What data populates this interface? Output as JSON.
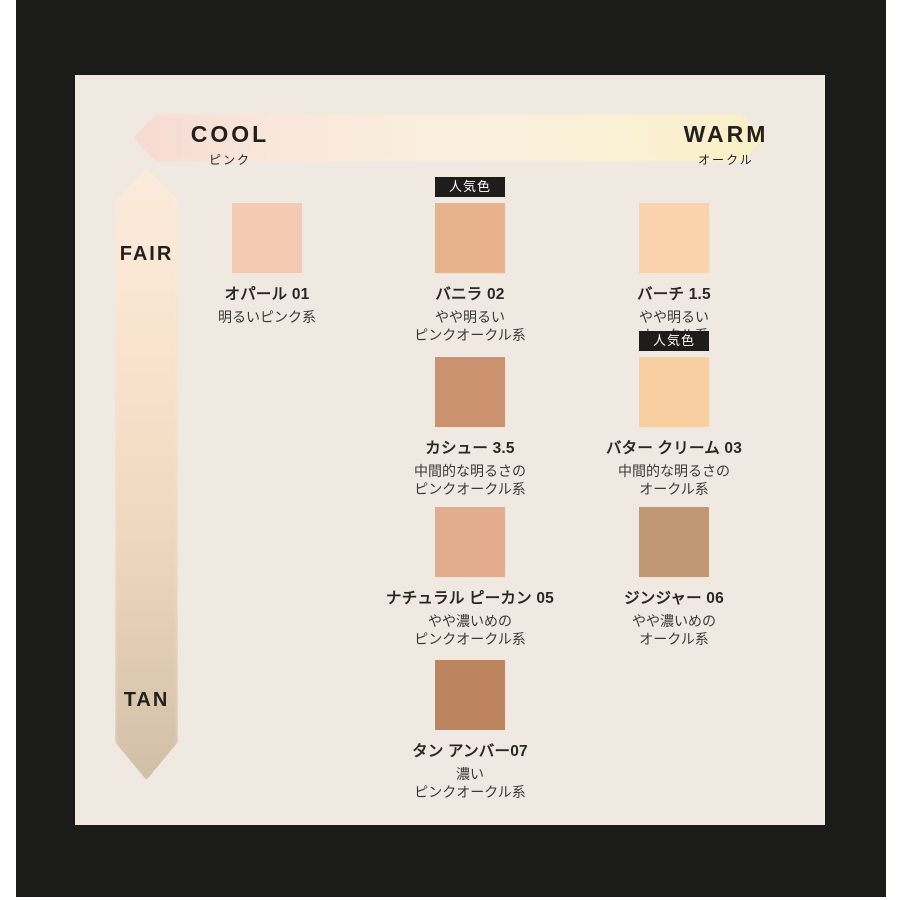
{
  "page": {
    "background": "#FFFFFF",
    "frame_color": "#1B1B19",
    "panel_color": "#F0E9E2"
  },
  "axes": {
    "horizontal": {
      "left_label": "COOL",
      "left_sublabel": "ピンク",
      "right_label": "WARM",
      "right_sublabel": "オークル",
      "gradient_left": "#F7DAD2",
      "gradient_mid": "#FAEFDF",
      "gradient_right": "#FAF0C5"
    },
    "vertical": {
      "top_label": "FAIR",
      "bottom_label": "TAN",
      "gradient_top": "#FCEBDB",
      "gradient_bottom": "#D2BFA8"
    }
  },
  "badge": {
    "label": "人気色",
    "bg": "#1E1D1B",
    "text_color": "#FFFFFF"
  },
  "swatches": [
    {
      "name": "オパール 01",
      "desc": [
        "明るいピンク系"
      ],
      "color": "#F4CBB2",
      "popular": false,
      "col": 0,
      "row": 0
    },
    {
      "name": "バニラ 02",
      "desc": [
        "やや明るい",
        "ピンクオークル系"
      ],
      "color": "#E8B28C",
      "popular": true,
      "col": 1,
      "row": 0
    },
    {
      "name": "バーチ 1.5",
      "desc": [
        "やや明るい",
        "オークル系"
      ],
      "color": "#FAD2AC",
      "popular": false,
      "col": 2,
      "row": 0
    },
    {
      "name": "カシュー 3.5",
      "desc": [
        "中間的な明るさの",
        "ピンクオークル系"
      ],
      "color": "#CB9270",
      "popular": false,
      "col": 1,
      "row": 1
    },
    {
      "name": "バター クリーム 03",
      "desc": [
        "中間的な明るさの",
        "オークル系"
      ],
      "color": "#F8CFA1",
      "popular": true,
      "col": 2,
      "row": 1
    },
    {
      "name": "ナチュラル ピーカン 05",
      "desc": [
        "やや濃いめの",
        "ピンクオークル系"
      ],
      "color": "#E3AC8E",
      "popular": false,
      "col": 1,
      "row": 2
    },
    {
      "name": "ジンジャー 06",
      "desc": [
        "やや濃いめの",
        "オークル系"
      ],
      "color": "#C09873",
      "popular": false,
      "col": 2,
      "row": 2
    },
    {
      "name": "タン アンバー07",
      "desc": [
        "濃い",
        "ピンクオークル系"
      ],
      "color": "#BD855F",
      "popular": false,
      "col": 1,
      "row": 3
    }
  ],
  "chart_data": {
    "type": "scatter",
    "title": "ファンデーション シェードチャート",
    "xlabel": "undertone: COOL (ピンク) → WARM (オークル)",
    "ylabel": "depth: FAIR → TAN",
    "legend": [
      "人気色 = popular shade"
    ],
    "points": [
      {
        "name": "オパール 01",
        "undertone": "ピンク系",
        "undertone_col": 0,
        "depth_row": 0,
        "depth": "明るい",
        "hex": "#F4CBB2",
        "popular": false
      },
      {
        "name": "バニラ 02",
        "undertone": "ピンクオークル系",
        "undertone_col": 1,
        "depth_row": 0,
        "depth": "やや明るい",
        "hex": "#E8B28C",
        "popular": true
      },
      {
        "name": "バーチ 1.5",
        "undertone": "オークル系",
        "undertone_col": 2,
        "depth_row": 0,
        "depth": "やや明るい",
        "hex": "#FAD2AC",
        "popular": false
      },
      {
        "name": "カシュー 3.5",
        "undertone": "ピンクオークル系",
        "undertone_col": 1,
        "depth_row": 1,
        "depth": "中間的な明るさ",
        "hex": "#CB9270",
        "popular": false
      },
      {
        "name": "バター クリーム 03",
        "undertone": "オークル系",
        "undertone_col": 2,
        "depth_row": 1,
        "depth": "中間的な明るさ",
        "hex": "#F8CFA1",
        "popular": true
      },
      {
        "name": "ナチュラル ピーカン 05",
        "undertone": "ピンクオークル系",
        "undertone_col": 1,
        "depth_row": 2,
        "depth": "やや濃いめ",
        "hex": "#E3AC8E",
        "popular": false
      },
      {
        "name": "ジンジャー 06",
        "undertone": "オークル系",
        "undertone_col": 2,
        "depth_row": 2,
        "depth": "やや濃いめ",
        "hex": "#C09873",
        "popular": false
      },
      {
        "name": "タン アンバー07",
        "undertone": "ピンクオークル系",
        "undertone_col": 1,
        "depth_row": 3,
        "depth": "濃い",
        "hex": "#BD855F",
        "popular": false
      }
    ]
  }
}
